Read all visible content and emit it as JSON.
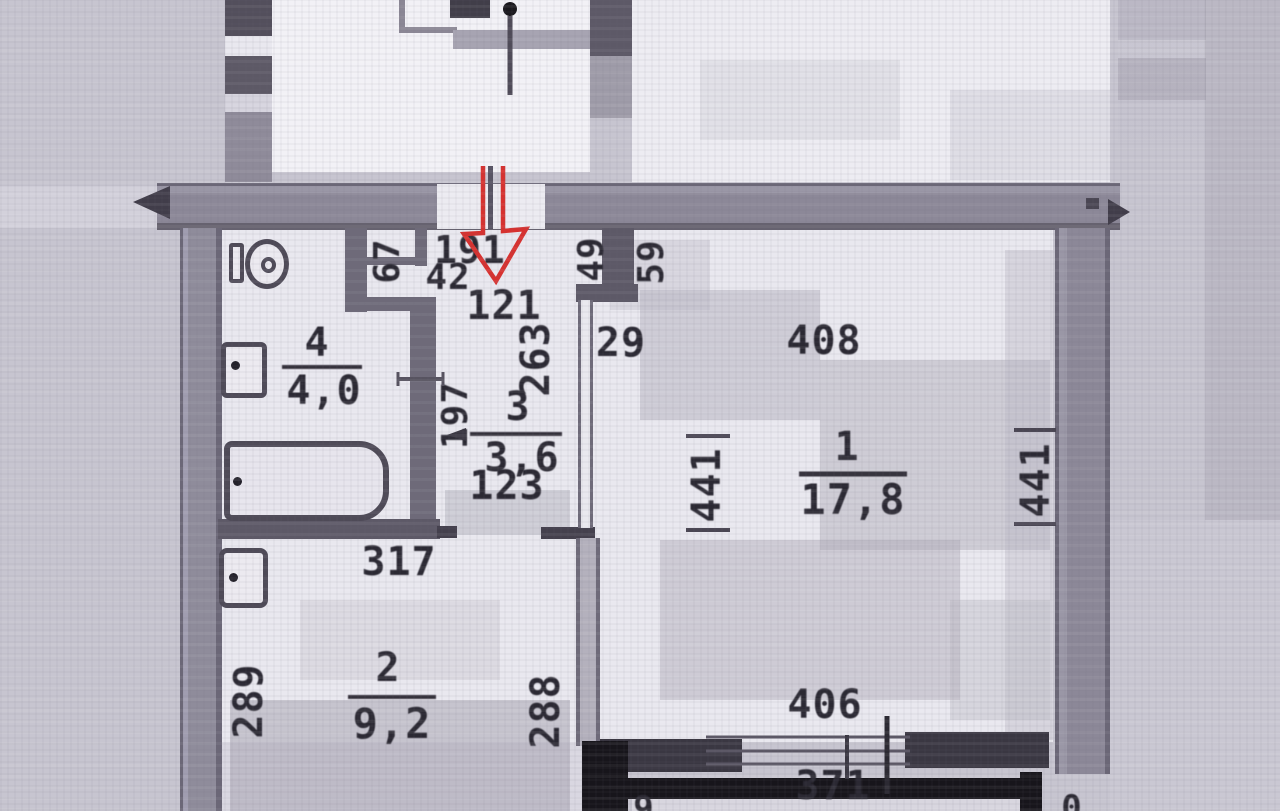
{
  "rooms": [
    {
      "number": "1",
      "area": "17,8"
    },
    {
      "number": "2",
      "area": "9,2"
    },
    {
      "number": "3",
      "area": "3,6"
    },
    {
      "number": "4",
      "area": "4,0"
    }
  ],
  "dimensions": {
    "niche_67": "67",
    "entry_191": "191",
    "entry_42": "42",
    "entry_121": "121",
    "pier_49": "49",
    "pier_59": "59",
    "hall_263": "263",
    "pier_29": "29",
    "bath_197": "197",
    "hall_123": "123",
    "kitchen_317": "317",
    "kitchen_289": "289",
    "kitchen_288": "288",
    "room1_408": "408",
    "room1_441_left": "441",
    "room1_441_right": "441",
    "window_406": "406",
    "window_371": "371",
    "cut_bottom_left": "9",
    "cut_bottom_right": "0"
  },
  "colors": {
    "arrow_red": "#d7312f",
    "ink": "#2b2933",
    "wall_gray": "#8f8b9b",
    "wall_dark": "#3a3742",
    "black": "#17151b",
    "paper": "#e9e8ef",
    "background": "#c7c5d0"
  }
}
